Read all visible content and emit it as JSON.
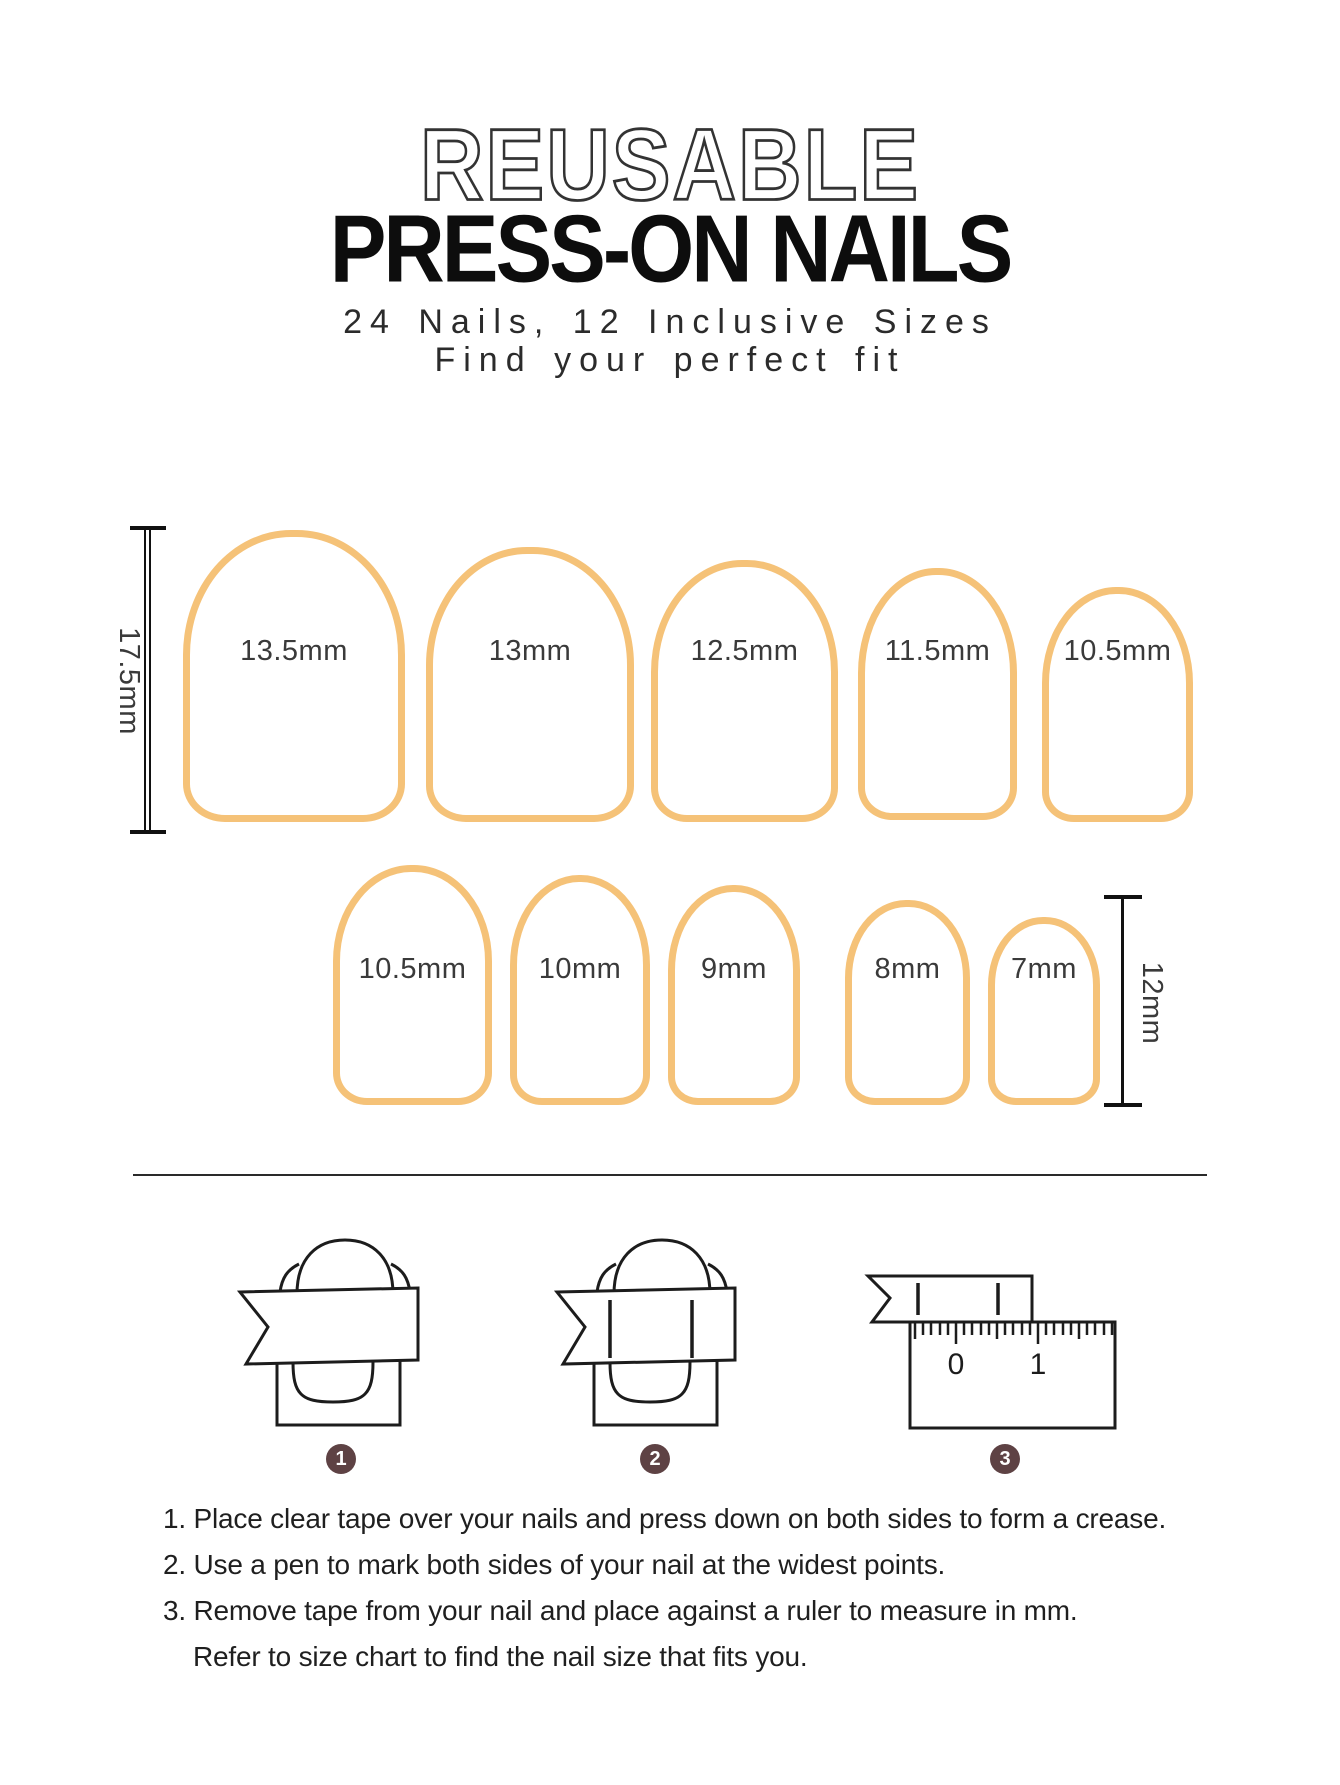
{
  "header": {
    "title_outline": "REUSABLE",
    "title_main": "PRESS-ON NAILS",
    "subtitle_line1": "24 Nails, 12 Inclusive Sizes",
    "subtitle_line2": "Find your perfect fit"
  },
  "size_chart": {
    "nail_outline_color": "#F5C278",
    "row1": {
      "length_label": "17.5mm",
      "nails": [
        {
          "label": "13.5mm"
        },
        {
          "label": "13mm"
        },
        {
          "label": "12.5mm"
        },
        {
          "label": "11.5mm"
        },
        {
          "label": "10.5mm"
        }
      ]
    },
    "row2": {
      "length_label": "12mm",
      "nails": [
        {
          "label": "10.5mm"
        },
        {
          "label": "10mm"
        },
        {
          "label": "9mm"
        },
        {
          "label": "8mm"
        },
        {
          "label": "7mm"
        }
      ]
    }
  },
  "steps": {
    "badge_color": "#5E4244",
    "badges": [
      "1",
      "2",
      "3"
    ],
    "ruler": {
      "zero": "0",
      "one": "1"
    }
  },
  "instructions": {
    "lines": [
      "1. Place clear tape over your nails and press down on both sides to form a crease.",
      "2. Use a pen to mark both sides of your nail at the widest points.",
      "3. Remove tape from your nail and place against a ruler to measure in mm.",
      "Refer to size chart to find the nail size that fits you."
    ]
  }
}
